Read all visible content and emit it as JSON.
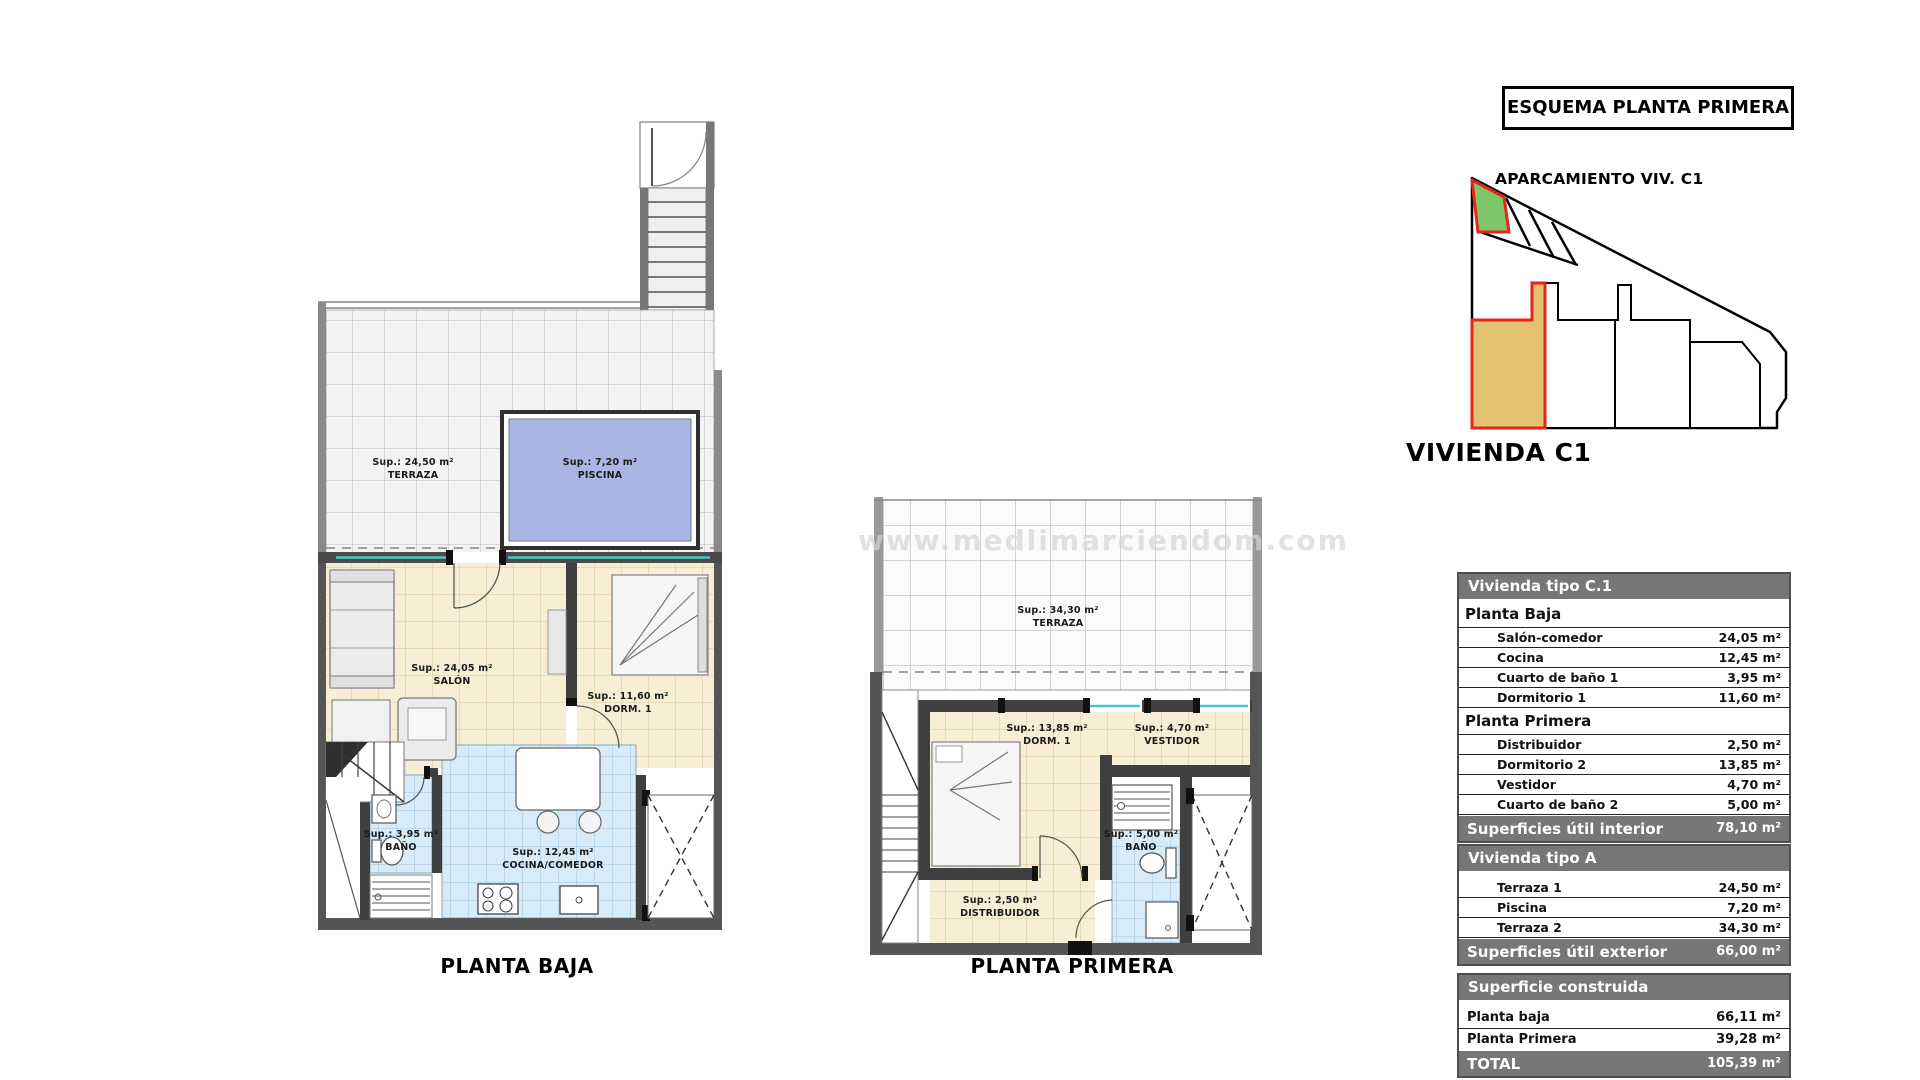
{
  "watermark": {
    "text": "www.medlimarciendom.com"
  },
  "esquema": {
    "title": "ESQUEMA PLANTA PRIMERA",
    "parking_label": "APARCAMIENTO VIV. C1",
    "vivienda_label": "VIVIENDA C1",
    "colors": {
      "parking_fill": "#7cc668",
      "unit_fill": "#e3c272",
      "highlight_stroke": "#e8251c"
    }
  },
  "plans": {
    "planta_baja": {
      "caption": "PLANTA BAJA",
      "rooms": {
        "terraza": {
          "sup": "Sup.: 24,50 m²",
          "name": "TERRAZA"
        },
        "piscina": {
          "sup": "Sup.: 7,20 m²",
          "name": "PISCINA"
        },
        "salon": {
          "sup": "Sup.: 24,05 m²",
          "name": "SALÓN"
        },
        "dorm1": {
          "sup": "Sup.: 11,60 m²",
          "name": "DORM. 1"
        },
        "bano": {
          "sup": "Sup.: 3,95 m²",
          "name": "BAÑO"
        },
        "cocina": {
          "sup": "Sup.: 12,45 m²",
          "name": "COCINA/COMEDOR"
        }
      }
    },
    "planta_primera": {
      "caption": "PLANTA PRIMERA",
      "rooms": {
        "terraza": {
          "sup": "Sup.: 34,30 m²",
          "name": "TERRAZA"
        },
        "dorm1": {
          "sup": "Sup.: 13,85 m²",
          "name": "DORM. 1"
        },
        "vestidor": {
          "sup": "Sup.: 4,70 m²",
          "name": "VESTIDOR"
        },
        "bano": {
          "sup": "Sup.: 5,00 m²",
          "name": "BAÑO"
        },
        "distribuidor": {
          "sup": "Sup.: 2,50 m²",
          "name": "DISTRIBUIDOR"
        }
      }
    },
    "colors": {
      "wall": "#555555",
      "floor_cream": "#f8eed6",
      "floor_blue": "#d8ebf8",
      "pool": "#aab6e3",
      "terrace_tile": "#f3f3f3",
      "window_teal": "#49c8c8"
    }
  },
  "tables": {
    "interior": {
      "title": "Vivienda tipo C.1",
      "sections": [
        {
          "heading": "Planta Baja",
          "rows": [
            [
              "Salón-comedor",
              "24,05 m²"
            ],
            [
              "Cocina",
              "12,45 m²"
            ],
            [
              "Cuarto de baño 1",
              "3,95 m²"
            ],
            [
              "Dormitorio 1",
              "11,60 m²"
            ]
          ]
        },
        {
          "heading": "Planta Primera",
          "rows": [
            [
              "Distribuidor",
              "2,50 m²"
            ],
            [
              "Dormitorio 2",
              "13,85 m²"
            ],
            [
              "Vestidor",
              "4,70 m²"
            ],
            [
              "Cuarto de baño 2",
              "5,00 m²"
            ]
          ]
        }
      ],
      "footer": {
        "label": "Superficies útil interior",
        "value": "78,10 m²"
      }
    },
    "exterior": {
      "title": "Vivienda tipo A",
      "rows": [
        [
          "Terraza 1",
          "24,50 m²"
        ],
        [
          "Piscina",
          "7,20 m²"
        ],
        [
          "Terraza 2",
          "34,30 m²"
        ]
      ],
      "footer": {
        "label": "Superficies útil exterior",
        "value": "66,00 m²"
      }
    },
    "construida": {
      "title": "Superficie construida",
      "rows": [
        [
          "Planta baja",
          "66,11 m²"
        ],
        [
          "Planta Primera",
          "39,28 m²"
        ]
      ],
      "footer": {
        "label": "TOTAL",
        "value": "105,39 m²"
      }
    }
  }
}
